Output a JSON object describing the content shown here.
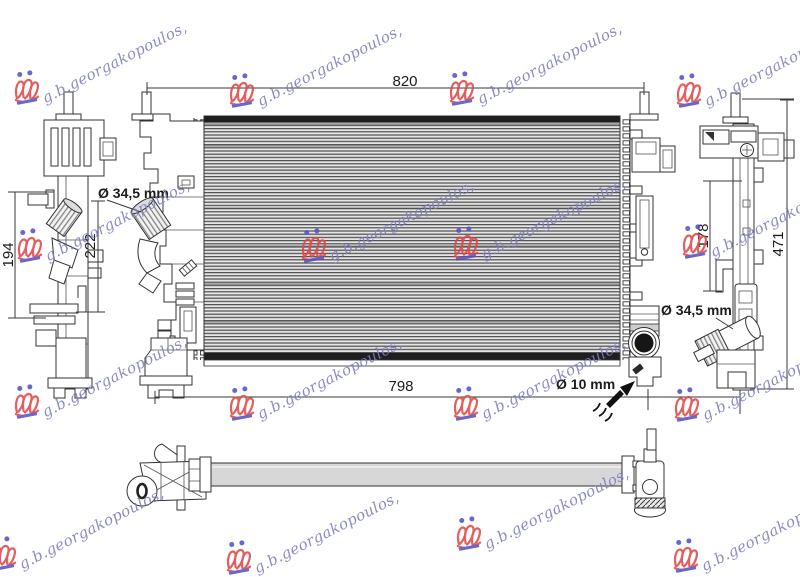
{
  "page": {
    "background": "#ffffff"
  },
  "dimensions": {
    "width_top": {
      "label": "820"
    },
    "width_bottom": {
      "label": "798"
    },
    "left_height_inner": {
      "label": "194"
    },
    "left_height_outer": {
      "label": "222"
    },
    "right_height_inner": {
      "label": "178"
    },
    "right_height_outer": {
      "label": "471"
    },
    "inlet_diameter_left": {
      "label": "Ø 34,5 mm"
    },
    "inlet_diameter_right": {
      "label": "Ø 34,5 mm"
    },
    "bleed_screw_diameter": {
      "label": "Ø 10 mm"
    }
  },
  "watermark": {
    "text": "g.b.georgakopoulos,",
    "text_color": "#7d7dbe",
    "emblem_red": "#e04848",
    "emblem_blue": "#5353c8",
    "units": [
      {
        "x": 13,
        "y": 70,
        "e": 1
      },
      {
        "x": 228,
        "y": 73,
        "e": 1
      },
      {
        "x": 448,
        "y": 71,
        "e": 1
      },
      {
        "x": 675,
        "y": 73,
        "e": 1
      },
      {
        "x": 16,
        "y": 228,
        "e": 1
      },
      {
        "x": 300,
        "y": 228,
        "e": 1
      },
      {
        "x": 452,
        "y": 226,
        "e": 1
      },
      {
        "x": 681,
        "y": 224,
        "e": 1
      },
      {
        "x": 13,
        "y": 384,
        "e": 1
      },
      {
        "x": 228,
        "y": 386,
        "e": 1
      },
      {
        "x": 452,
        "y": 386,
        "e": 1
      },
      {
        "x": 673,
        "y": 387,
        "e": 1
      },
      {
        "x": -10,
        "y": 536,
        "e": 1
      },
      {
        "x": 225,
        "y": 540,
        "e": 1
      },
      {
        "x": 455,
        "y": 516,
        "e": 1
      },
      {
        "x": 672,
        "y": 538,
        "e": 1
      }
    ]
  },
  "drawing": {
    "line_color": "#333333",
    "core_fill": "#d2d2d2"
  }
}
